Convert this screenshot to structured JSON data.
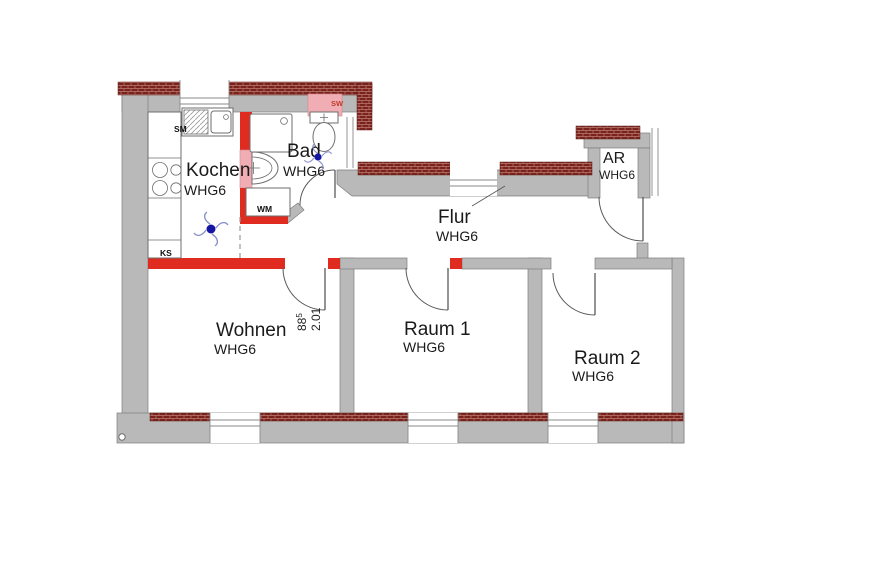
{
  "plan": {
    "title": "Wohnung WHG6 Grundriss",
    "rooms": [
      {
        "id": "kochen",
        "name": "Kochen",
        "unit": "WHG6"
      },
      {
        "id": "bad",
        "name": "Bad",
        "unit": "WHG6"
      },
      {
        "id": "flur",
        "name": "Flur",
        "unit": "WHG6"
      },
      {
        "id": "ar",
        "name": "AR",
        "unit": "WHG6"
      },
      {
        "id": "wohnen",
        "name": "Wohnen",
        "unit": "WHG6"
      },
      {
        "id": "raum1",
        "name": "Raum 1",
        "unit": "WHG6"
      },
      {
        "id": "raum2",
        "name": "Raum 2",
        "unit": "WHG6"
      }
    ],
    "labels": {
      "sink_unit": "SM",
      "washing_machine": "WM",
      "fridge": "KS",
      "shaft": "SW"
    },
    "dimension": {
      "width_value": "88",
      "width_sup": "5",
      "height_value": "2.01"
    },
    "colors": {
      "wall_gray": "#b9b9b9",
      "wall_red": "#e02b20",
      "brick": "#7a231d",
      "brick_mortar": "#bb7b72",
      "shaft_pink": "#f0aeb4",
      "symbol_blue": "#1515a3",
      "text": "#1a1a1a"
    }
  }
}
